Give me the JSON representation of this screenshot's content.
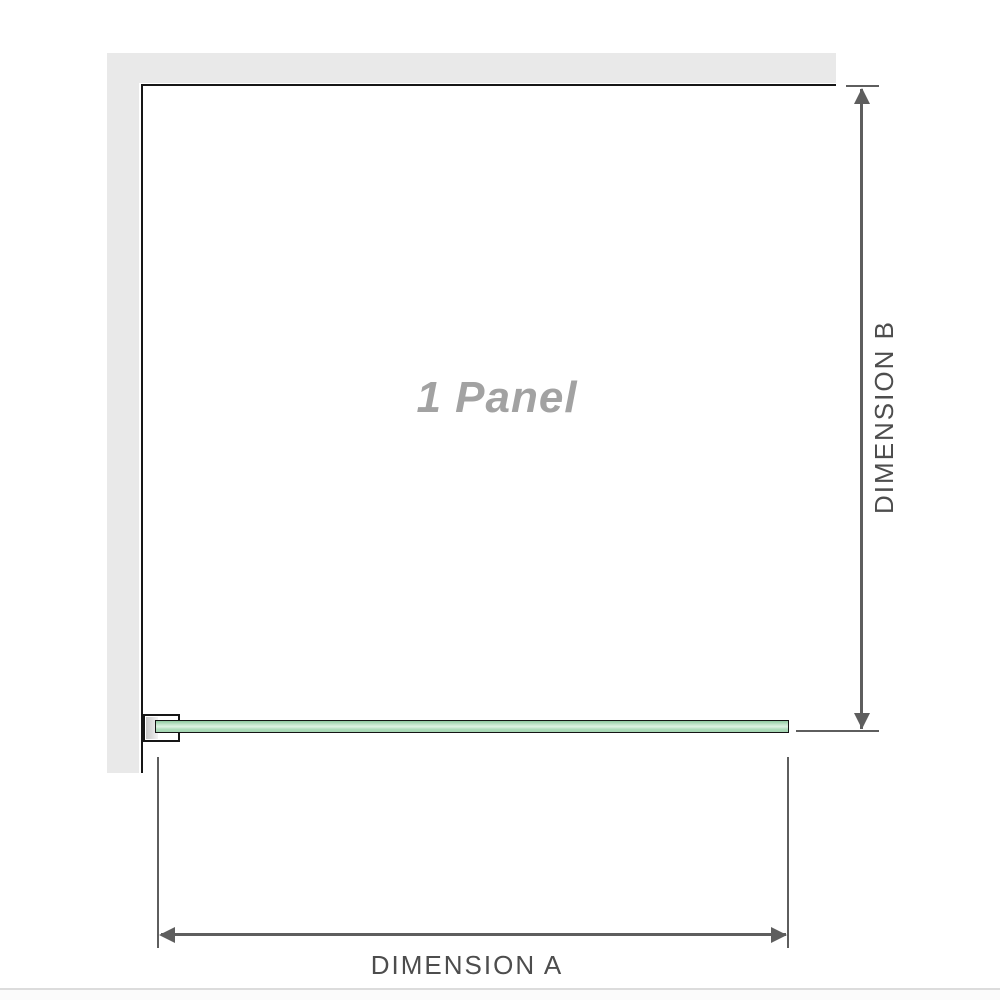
{
  "diagram": {
    "panel_label": "1 Panel",
    "dimensions": {
      "a_label": "DIMENSION A",
      "b_label": "DIMENSION B"
    },
    "colors": {
      "wall_gray": "#e9e9e9",
      "outline_black": "#161616",
      "glass_green": "#aedcbb",
      "glass_green_highlight": "#ddf2e2",
      "glass_green_shadow": "#8fc9a0",
      "bracket_pad_gray": "#c6c6c6",
      "dimension_line_gray": "#5e5e5e",
      "dimension_label_gray": "#4d4d4d",
      "panel_label_gray": "#a2a2a2",
      "divider_gray": "#dcdcdc"
    }
  }
}
